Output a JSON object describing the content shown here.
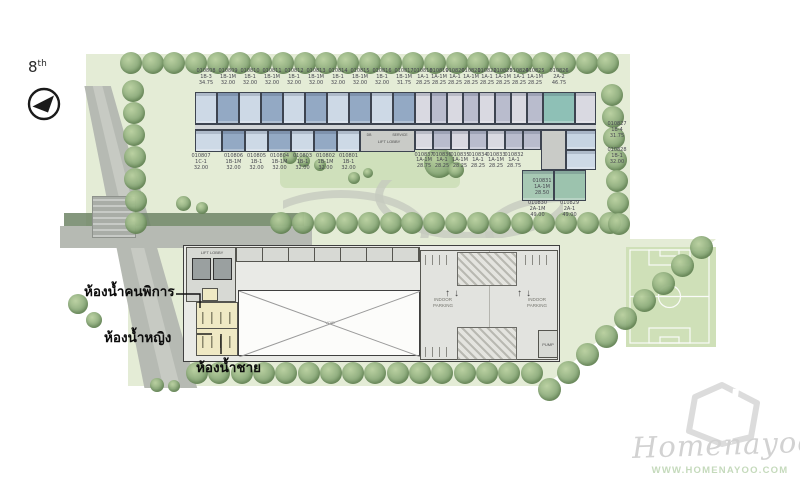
{
  "floor": {
    "number": "8",
    "suffix": "th"
  },
  "annotations": {
    "toilet_disabled": "ห้องน้ำคนพิการ",
    "toilet_female": "ห้องน้ำหญิง",
    "toilet_male": "ห้องน้ำชาย"
  },
  "upper_building": {
    "top_units": [
      {
        "no": "010808",
        "type": "1B-3",
        "area": "34.75"
      },
      {
        "no": "010809",
        "type": "1B-1M",
        "area": "32.00"
      },
      {
        "no": "010810",
        "type": "1B-1",
        "area": "32.00"
      },
      {
        "no": "010811",
        "type": "1B-1M",
        "area": "32.00"
      },
      {
        "no": "010812",
        "type": "1B-1",
        "area": "32.00"
      },
      {
        "no": "010813",
        "type": "1B-1M",
        "area": "32.00"
      },
      {
        "no": "010814",
        "type": "1B-1",
        "area": "32.00"
      },
      {
        "no": "010815",
        "type": "1B-1M",
        "area": "32.00"
      },
      {
        "no": "010816",
        "type": "1B-1",
        "area": "32.00"
      },
      {
        "no": "010817",
        "type": "1B-1M",
        "area": "31.75"
      },
      {
        "no": "010818",
        "type": "1A-1",
        "area": "28.25"
      },
      {
        "no": "010819",
        "type": "1A-1M",
        "area": "28.25"
      },
      {
        "no": "010820",
        "type": "1A-1",
        "area": "28.25"
      },
      {
        "no": "010821",
        "type": "1A-1M",
        "area": "28.25"
      },
      {
        "no": "010822",
        "type": "1A-1",
        "area": "28.25"
      },
      {
        "no": "010823",
        "type": "1A-1M",
        "area": "28.25"
      },
      {
        "no": "010824",
        "type": "1A-1",
        "area": "28.25"
      },
      {
        "no": "010825",
        "type": "1A-1M",
        "area": "28.25"
      },
      {
        "no": "010826",
        "type": "2A-2",
        "area": "46.75"
      }
    ],
    "bottom_left_units": [
      {
        "no": "010807",
        "type": "1C-1",
        "area": "32.00"
      },
      {
        "no": "010806",
        "type": "1B-1M",
        "area": "32.00"
      },
      {
        "no": "010805",
        "type": "1B-1",
        "area": "32.00"
      },
      {
        "no": "010804",
        "type": "1B-1M",
        "area": "32.00"
      },
      {
        "no": "010803",
        "type": "1B-1",
        "area": "32.00"
      },
      {
        "no": "010802",
        "type": "1B-1M",
        "area": "32.00"
      },
      {
        "no": "010801",
        "type": "1B-1",
        "area": "32.00"
      }
    ],
    "bottom_mid_units": [
      {
        "no": "010837",
        "type": "1A-1M",
        "area": "28.75"
      },
      {
        "no": "010836",
        "type": "1A-1",
        "area": "28.25"
      },
      {
        "no": "010835",
        "type": "1A-1M",
        "area": "28.25"
      },
      {
        "no": "010834",
        "type": "1A-1",
        "area": "28.25"
      },
      {
        "no": "010833",
        "type": "1A-1M",
        "area": "28.25"
      },
      {
        "no": "010832",
        "type": "1A-1",
        "area": "28.75"
      }
    ],
    "inner_unit": {
      "no": "010831",
      "type": "1A-1M",
      "area": "28.50"
    },
    "right_units": [
      {
        "no": "010827",
        "type": "1B-4",
        "area": "31.75"
      },
      {
        "no": "010828",
        "type": "1B-1",
        "area": "32.00"
      }
    ],
    "corner_units": [
      {
        "no": "010830",
        "type": "2A-1M",
        "area": "49.00"
      },
      {
        "no": "010829",
        "type": "2A-1",
        "area": "49.00"
      }
    ],
    "core": {
      "lift": "LIFT LOBBY",
      "db": "DB",
      "service": "SERVICE"
    }
  },
  "lower_building": {
    "lift_lobby": "LIFT LOBBY",
    "void_label": "VOID",
    "pump": "PUMP",
    "parking_left": "INDOOR PARKING",
    "parking_right": "INDOOR PARKING"
  },
  "watermark": {
    "brand": "Homenayoo",
    "url": "WWW.HOMENAYOO.COM"
  },
  "colors": {
    "unit_blue_light": "#cdd9e6",
    "unit_blue_dark": "#93a9c4",
    "unit_gray_light": "#d9d9e1",
    "unit_gray_dark": "#b9bccd",
    "unit_teal": "#8ec0b6",
    "unit_green_light": "#a7c9b4",
    "unit_green_dark": "#9cc3ae",
    "unit_blue_pale": "#c6d4e2",
    "site_green": "#e4ecd6",
    "court_green": "#cfe0b8",
    "road_gray": "#b6bab3",
    "walkway_green": "#6f8566",
    "restroom_yellow": "#efe9c4"
  }
}
